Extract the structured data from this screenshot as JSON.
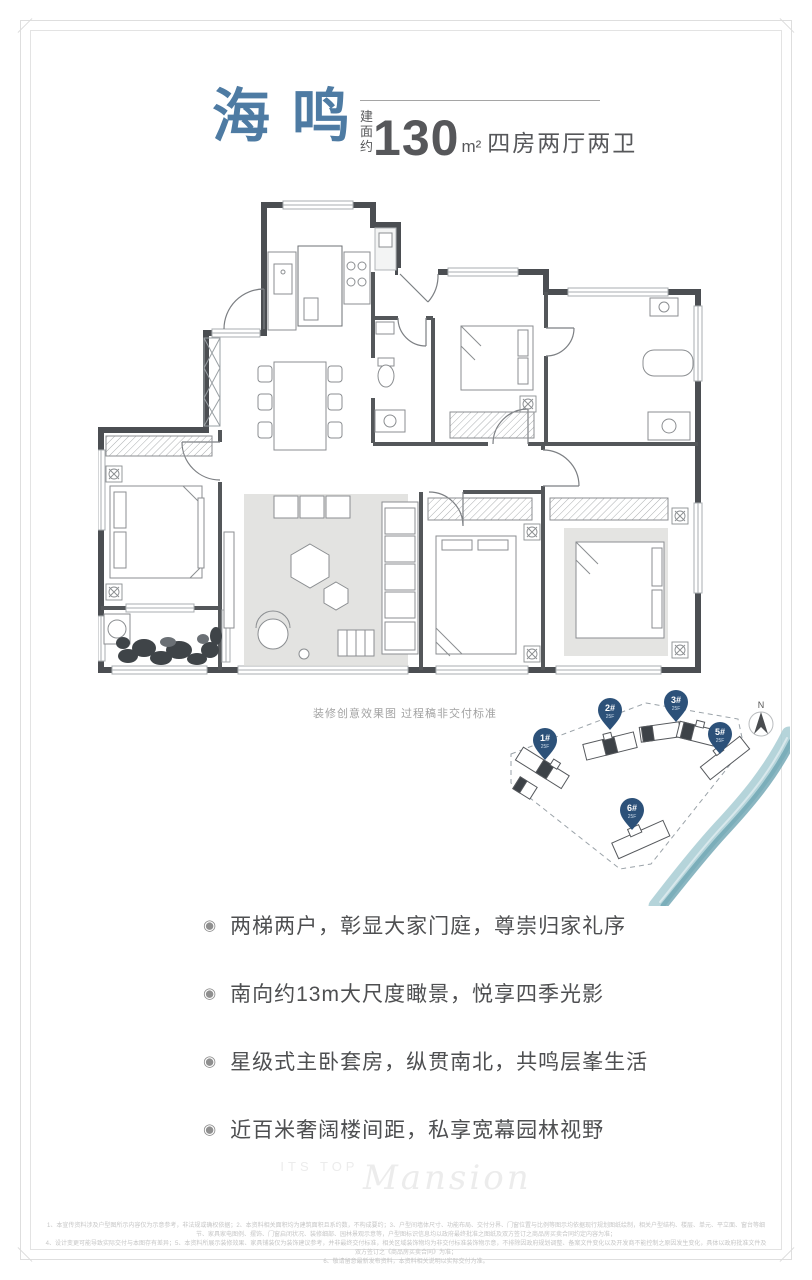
{
  "header": {
    "title": "海鸣",
    "area_prefix": "建面约",
    "area_value": "130",
    "area_unit": "m²",
    "layout_desc": "四房两厅两卫"
  },
  "floorplan": {
    "caption": "装修创意效果图 过程稿非交付标准"
  },
  "siteplan": {
    "compass": "N",
    "pins": [
      {
        "id": "1#",
        "floors": "25F"
      },
      {
        "id": "2#",
        "floors": "25F"
      },
      {
        "id": "3#",
        "floors": "25F"
      },
      {
        "id": "5#",
        "floors": "25F"
      },
      {
        "id": "6#",
        "floors": "25F"
      }
    ]
  },
  "selling_points": [
    "两梯两户，彰显大家门庭，尊崇归家礼序",
    "南向约13m大尺度瞰景，悦享四季光影",
    "星级式主卧套房，纵贯南北，共鸣层峯生活",
    "近百米奢阔楼间距，私享宽幕园林视野"
  ],
  "watermark": {
    "prefix": "ITS TOP",
    "script": "Mansion"
  },
  "disclaimer": {
    "line1": "1、本宣传资料涉及户型图所示内容仅为示意参考，非法规或确权依据；2、本资料相关面积均为建筑面积且系约数，不构成要约；3、户型间墙体尺寸、功能布局、交付分界、门窗位置与比例等图示均依据现行规划图纸绘制，相关户型结构、楼层、单元、平立面、窗台等细节、家具家电图例、摆饰、门窗启闭状况、装修细部、园林景观示意等，户型图标识信息均以政府最终批准之图纸及双方签订之商品房买卖合同约定内容为准；",
    "line2": "4、设计变更可能导致实际交付与本图存有差异；5、本资料所展示装修效果、家具铺装仅为装饰建议参考，并非最终交付标准，相关区域装饰物均为非交付标准装饰物示意，不排除因政府规划调整、备案文件变化以及开发商不能控制之原因发生变化，具体以政府批准文件及双方签订之《商品房买卖合同》为准；",
    "line3": "6、敬请留意最新发布资料，本资料相关说明以实际交付为准。"
  },
  "colors": {
    "accent_blue": "#4e7ba3",
    "pin_blue": "#2c5179",
    "river_teal": "#86b5c1",
    "wall_dark": "#4b4e52"
  }
}
